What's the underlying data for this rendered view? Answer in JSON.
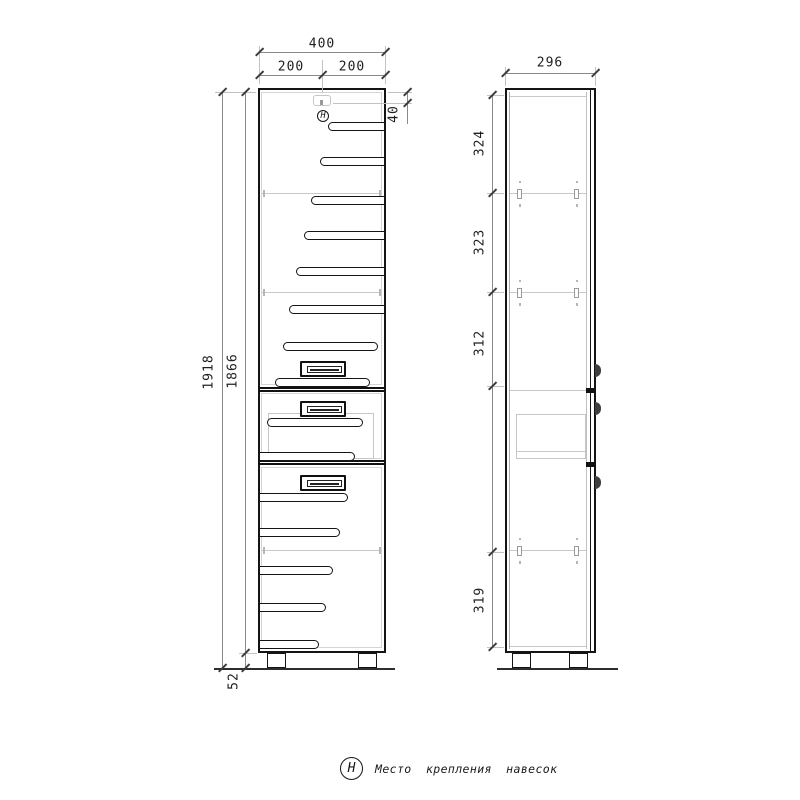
{
  "legend": {
    "symbol": "Н",
    "label": "Место крепления навесок"
  },
  "markers": {
    "hanger_symbol": "Н"
  },
  "dims": {
    "front": {
      "total_width": "400",
      "left_half": "200",
      "right_half": "200",
      "hanger_offset": "40",
      "total_height": "1918",
      "body_height": "1866",
      "leg_height": "52"
    },
    "side": {
      "depth": "296",
      "sect_top": "324",
      "sect_upper": "323",
      "sect_middle": "312",
      "sect_bottom": "319"
    }
  }
}
